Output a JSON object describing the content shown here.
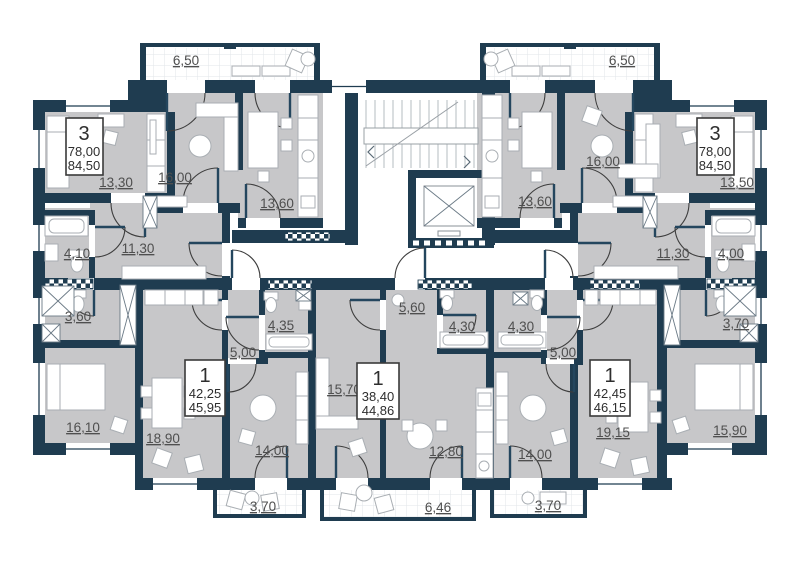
{
  "plan_type": "residential-floor-plan",
  "colors": {
    "wall": "#1f3c50",
    "room_fill": "#c7c7c9",
    "background": "#ffffff",
    "label_text": "#4f4f4f",
    "badge_text": "#2e2e2e"
  },
  "apartments": [
    {
      "id": "apt-3-left",
      "label": "3",
      "area1": "78,00",
      "area2": "84,50"
    },
    {
      "id": "apt-3-right",
      "label": "3",
      "area1": "78,00",
      "area2": "84,50"
    },
    {
      "id": "apt-1-left",
      "label": "1",
      "area1": "42,25",
      "area2": "45,95"
    },
    {
      "id": "apt-1-center",
      "label": "1",
      "area1": "38,40",
      "area2": "44,86"
    },
    {
      "id": "apt-1-right",
      "label": "1",
      "area1": "42,45",
      "area2": "46,15"
    }
  ],
  "room_labels": [
    {
      "id": "balcony-top-left",
      "area": "6,50"
    },
    {
      "id": "bedroom-left-1330",
      "area": "13,30"
    },
    {
      "id": "living-left-1600",
      "area": "16,00"
    },
    {
      "id": "kitchen-left-1360",
      "area": "13,60"
    },
    {
      "id": "bath-left-410",
      "area": "4,10"
    },
    {
      "id": "hall-left-1130",
      "area": "11,30"
    },
    {
      "id": "wc-left-360",
      "area": "3,60"
    },
    {
      "id": "bedroom-left-1610",
      "area": "16,10"
    },
    {
      "id": "balcony-top-right",
      "area": "6,50"
    },
    {
      "id": "kitchen-right-1360",
      "area": "13,60"
    },
    {
      "id": "living-right-1600",
      "area": "16,00"
    },
    {
      "id": "bedroom-right-1350",
      "area": "13,50"
    },
    {
      "id": "hall-right-1130",
      "area": "11,30"
    },
    {
      "id": "bath-right-400",
      "area": "4,00"
    },
    {
      "id": "wc-right-370",
      "area": "3,70"
    },
    {
      "id": "bedroom-right-1590",
      "area": "15,90"
    },
    {
      "id": "studio-bl-1890",
      "area": "18,90"
    },
    {
      "id": "hall-bl-500",
      "area": "5,00"
    },
    {
      "id": "bath-bl-435",
      "area": "4,35"
    },
    {
      "id": "room-bl-1400",
      "area": "14,00"
    },
    {
      "id": "balcony-bl-370",
      "area": "3,70"
    },
    {
      "id": "living-bc-1570",
      "area": "15,70"
    },
    {
      "id": "hall-bc-560",
      "area": "5,60"
    },
    {
      "id": "bath-bc-430",
      "area": "4,30"
    },
    {
      "id": "kitchen-bc-1280",
      "area": "12,80"
    },
    {
      "id": "balcony-bc-646",
      "area": "6,46"
    },
    {
      "id": "bath-br-430",
      "area": "4,30"
    },
    {
      "id": "hall-br-500",
      "area": "5,00"
    },
    {
      "id": "studio-br-1915",
      "area": "19,15"
    },
    {
      "id": "room-br-1400",
      "area": "14,00"
    },
    {
      "id": "balcony-br-370",
      "area": "3,70"
    }
  ]
}
